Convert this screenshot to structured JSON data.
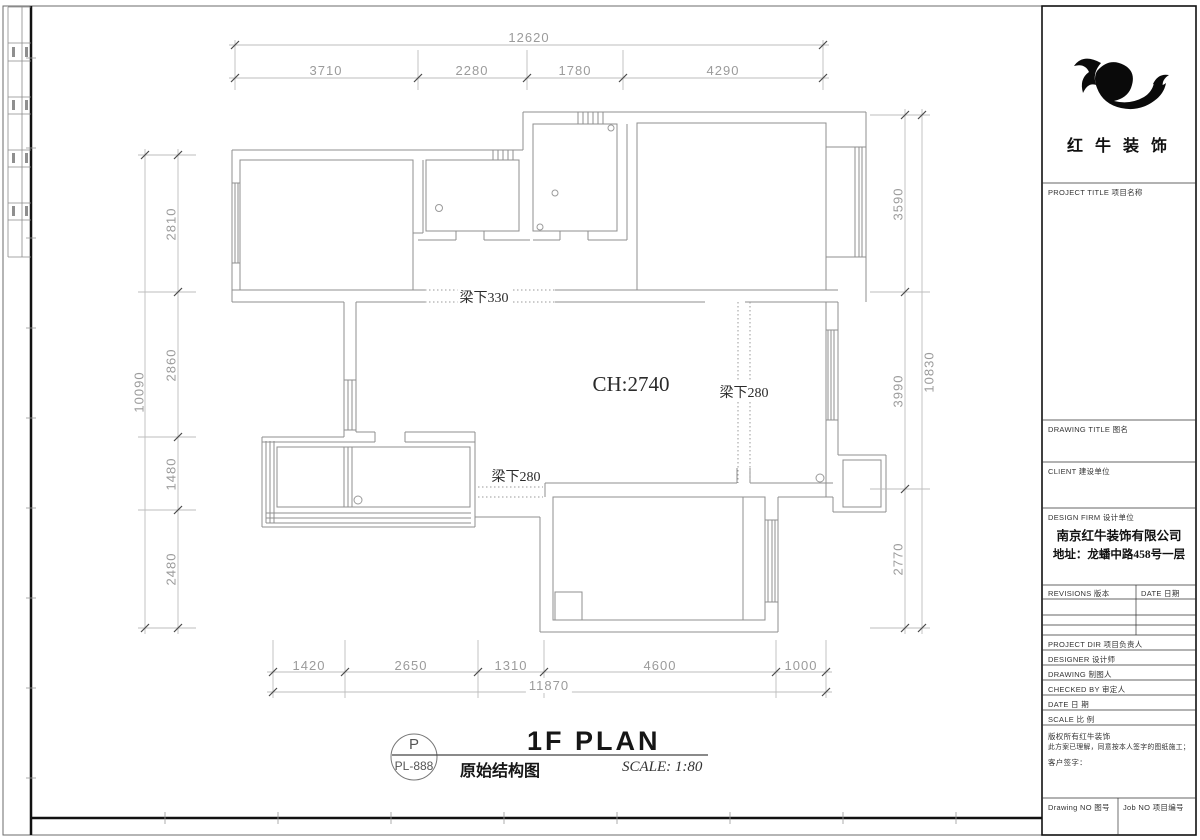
{
  "sheet": {
    "plan_title": "1F PLAN",
    "plan_subtitle": "原始结构图",
    "scale_note": "SCALE: 1:80",
    "bubble": {
      "letter": "P",
      "code": "PL-888"
    }
  },
  "annotations": {
    "ceiling_height": "CH:2740",
    "beam_330": "梁下330",
    "beam_280_a": "梁下280",
    "beam_280_b": "梁下280"
  },
  "dimensions": {
    "top": {
      "total": "12620",
      "segments": [
        "3710",
        "2280",
        "1780",
        "4290"
      ]
    },
    "left": {
      "total": "10090",
      "segments": [
        "2810",
        "2860",
        "1480",
        "2480"
      ]
    },
    "right": {
      "total": "10830",
      "segments": [
        "3590",
        "3990",
        "2770"
      ]
    },
    "bottom": {
      "total": "11870",
      "segments": [
        "1420",
        "2650",
        "1310",
        "4600",
        "1000"
      ]
    }
  },
  "title_block": {
    "company_logo_name": "红 牛 装 饰",
    "project_title_label": "PROJECT TITLE   项目名称",
    "drawing_title_label": "DRAWING TITLE   图名",
    "client_label": "CLIENT   建设单位",
    "design_firm_label": "DESIGN FIRM   设计单位",
    "company_name": "南京红牛装饰有限公司",
    "company_address": "地址：龙蟠中路458号一层",
    "revisions_label": "REVISIONS  版本",
    "date_col_label": "DATE 日期",
    "project_dir_label": "PROJECT DIR   项目负责人",
    "designer_label": "DESIGNER   设计师",
    "drawing_label": "DRAWING   制图人",
    "checked_by_label": "CHECKED BY   审定人",
    "date_label": "DATE   日  期",
    "scale_label": "SCALE   比  例",
    "copyright_line1": "版权所有红牛装饰",
    "copyright_line2": "此方案已理解，同意按本人签字的图纸施工；",
    "client_sign_label": "客户签字：",
    "drawing_no_label": "Drawing NO  图号",
    "job_no_label": "Job NO  项目编号"
  }
}
